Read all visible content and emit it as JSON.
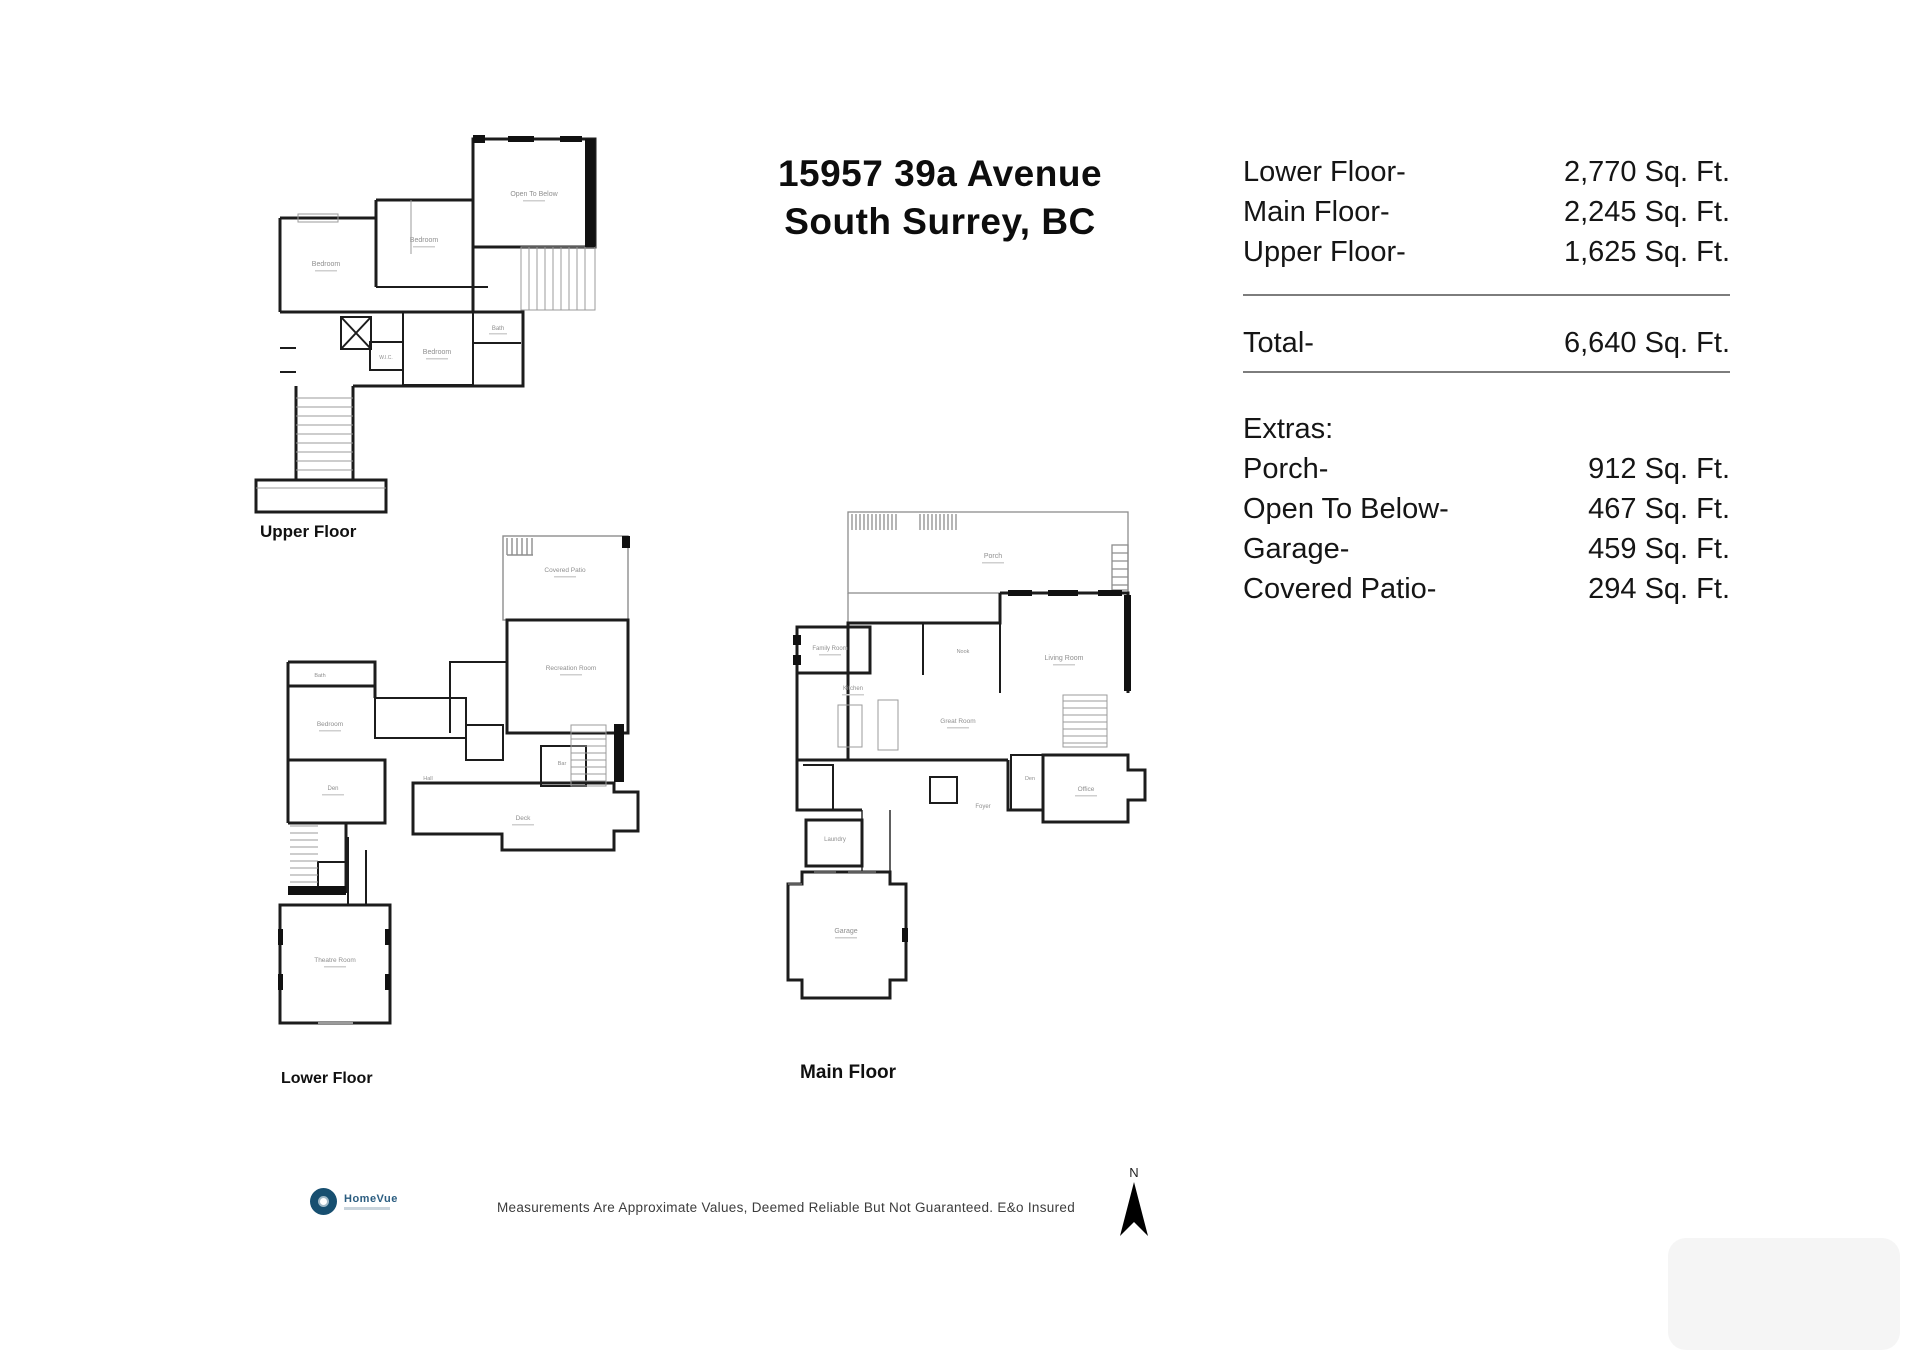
{
  "title": {
    "line1": "15957 39a Avenue",
    "line2": "South Surrey, BC"
  },
  "area_table": {
    "rows": [
      {
        "label": "Lower Floor-",
        "value": "2,770 Sq. Ft."
      },
      {
        "label": "Main Floor-",
        "value": "2,245 Sq. Ft."
      },
      {
        "label": "Upper Floor-",
        "value": "1,625 Sq. Ft."
      }
    ],
    "total": {
      "label": "Total-",
      "value": "6,640 Sq. Ft."
    },
    "extras_heading": "Extras:",
    "extras": [
      {
        "label": "Porch-",
        "value": "912 Sq. Ft."
      },
      {
        "label": "Open To Below-",
        "value": "467 Sq. Ft."
      },
      {
        "label": "Garage-",
        "value": "459 Sq. Ft."
      },
      {
        "label": "Covered Patio-",
        "value": "294 Sq. Ft."
      }
    ]
  },
  "floors": [
    {
      "label": "Upper Floor",
      "rooms": [
        {
          "label": "Open To Below"
        },
        {
          "label": "Bedroom"
        },
        {
          "label": "Bedroom"
        },
        {
          "label": "Bedroom"
        },
        {
          "label": "Bath"
        },
        {
          "label": "W.I.C."
        }
      ]
    },
    {
      "label": "Lower Floor",
      "rooms": [
        {
          "label": "Covered Patio"
        },
        {
          "label": "Recreation Room"
        },
        {
          "label": "Bedroom"
        },
        {
          "label": "Bath"
        },
        {
          "label": "Den"
        },
        {
          "label": "Hall"
        },
        {
          "label": "Deck"
        },
        {
          "label": "Theatre Room"
        },
        {
          "label": "Bar"
        }
      ]
    },
    {
      "label": "Main Floor",
      "rooms": [
        {
          "label": "Porch"
        },
        {
          "label": "Living Room"
        },
        {
          "label": "Family Room"
        },
        {
          "label": "Kitchen"
        },
        {
          "label": "Great Room"
        },
        {
          "label": "Nook"
        },
        {
          "label": "Den"
        },
        {
          "label": "Foyer"
        },
        {
          "label": "Office"
        },
        {
          "label": "Laundry"
        },
        {
          "label": "Garage"
        }
      ]
    }
  ],
  "footer": {
    "logo_text": "HomeVue",
    "disclaimer": "Measurements Are Approximate Values, Deemed Reliable But Not Guaranteed. E&o Insured",
    "north_label": "N"
  }
}
